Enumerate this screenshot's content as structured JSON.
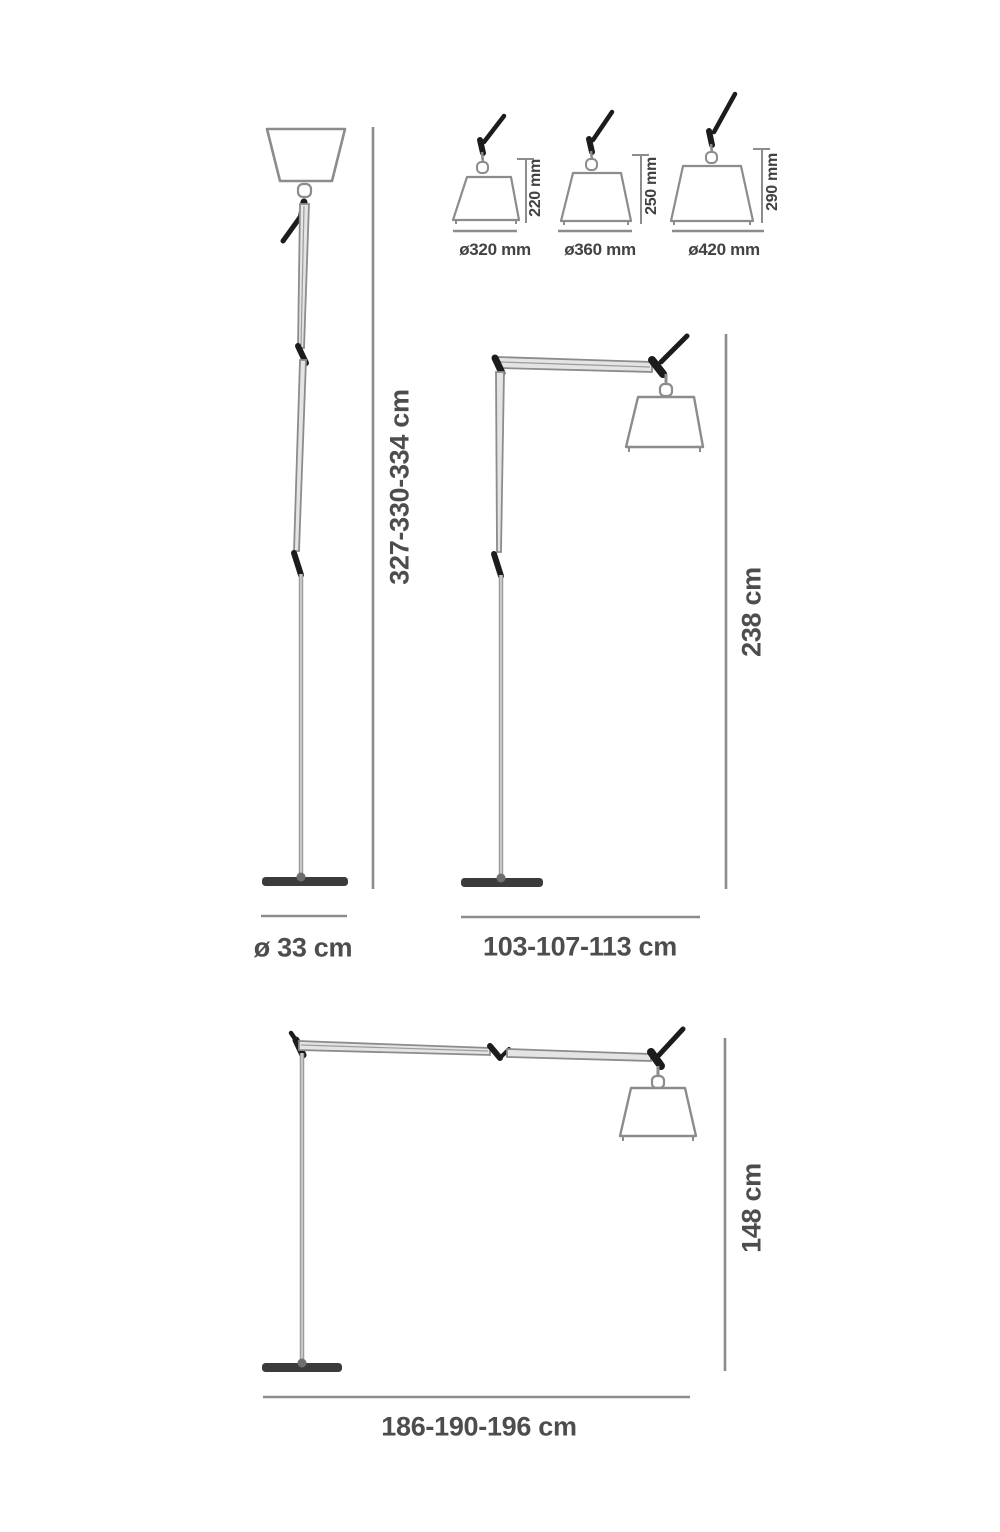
{
  "diagram": {
    "torchiere": {
      "height": "327-330-334 cm",
      "base_diameter": "ø 33 cm"
    },
    "shade_variants": [
      {
        "diameter": "ø320 mm",
        "height": "220 mm"
      },
      {
        "diameter": "ø360 mm",
        "height": "250 mm"
      },
      {
        "diameter": "ø420 mm",
        "height": "290 mm"
      }
    ],
    "floor_lamp_medium": {
      "height": "238 cm",
      "reach": "103-107-113 cm"
    },
    "floor_lamp_long": {
      "height": "148 cm",
      "reach": "186-190-196 cm"
    },
    "colors": {
      "line": "#8c8c8c",
      "joint": "#1c1c1c",
      "base": "#3b3b3b",
      "text": "#4d4d4d",
      "background": "#ffffff"
    }
  }
}
